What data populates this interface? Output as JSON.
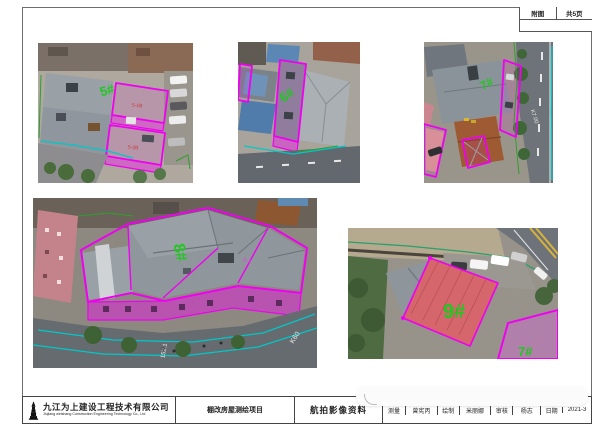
{
  "colors": {
    "outline_magenta": "#f000f0",
    "label_green": "#1fc81f",
    "survey_cyan": "#00c8c8",
    "boundary_green": "#2f9f2f",
    "frame_gray": "#6e6e6e"
  },
  "corner_table": {
    "cell_left": "附图",
    "cell_right": "共5页"
  },
  "photos": [
    {
      "name": "photo-building-5",
      "label": "5#",
      "sub_label_1": "5-1B",
      "sub_label_2": "5-2B"
    },
    {
      "name": "photo-building-6",
      "label": "6#"
    },
    {
      "name": "photo-building-7",
      "label": "7#",
      "road_text": "K7.00"
    },
    {
      "name": "photo-building-8",
      "label": "8#",
      "road_text": "K60",
      "road_text2": "152.1",
      "sub_label_1": "8-1"
    },
    {
      "name": "photo-building-9",
      "label": "9#",
      "secondary_label": "7#"
    }
  ],
  "title_block": {
    "company_cn": "九江为上建设工程技术有限公司",
    "company_en": "Jiujiang weishang Construction Engineering Technology Co., Ltd",
    "project": "棚改房屋测绘项目",
    "sheet_title": "航拍影像资料",
    "fields": [
      {
        "label": "测量",
        "value": "曾宪丙"
      },
      {
        "label": "绘制",
        "value": "米丽娜"
      },
      {
        "label": "审核",
        "value": "杨志"
      },
      {
        "label": "日期",
        "value": "2021-3"
      }
    ]
  }
}
